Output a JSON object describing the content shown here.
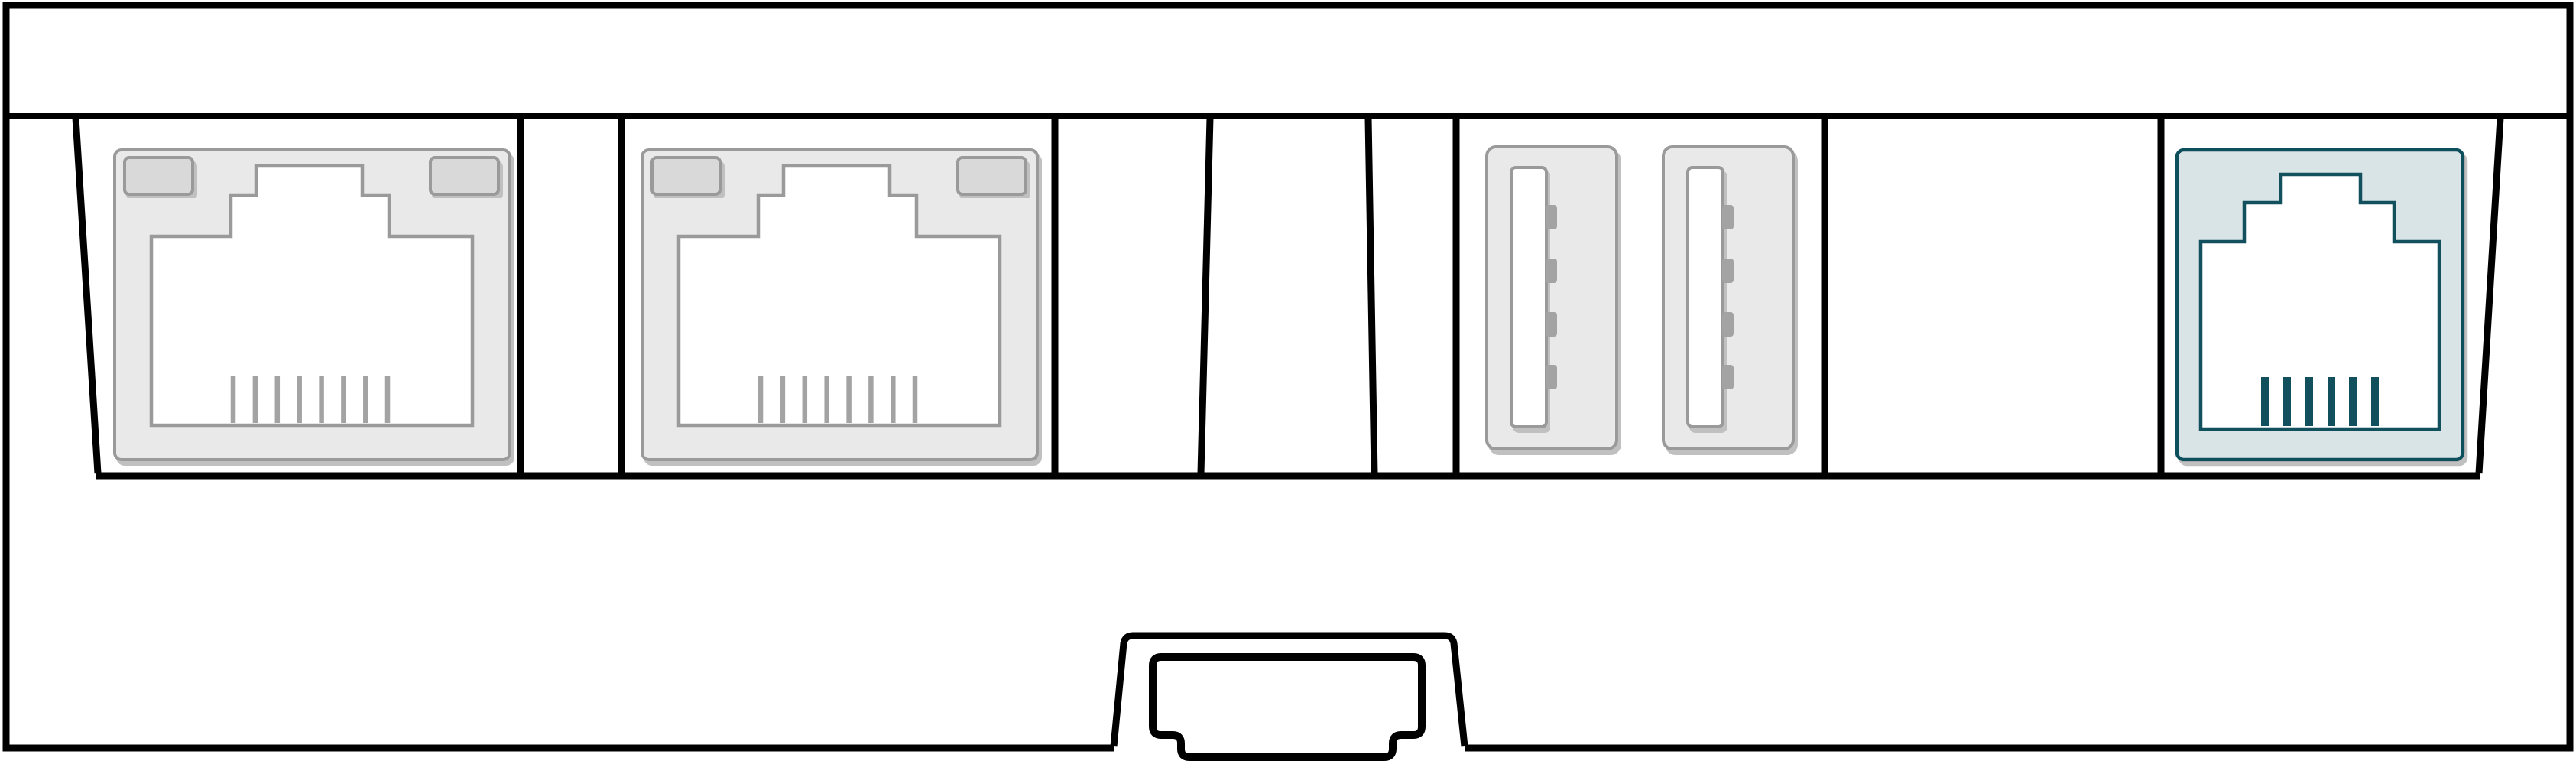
{
  "diagram": {
    "kind": "device-rear-panel-line-illustration",
    "ports": [
      {
        "id": "ethernet-port-1",
        "connector": "rj45",
        "pins": 8,
        "accent": false
      },
      {
        "id": "ethernet-port-2",
        "connector": "rj45",
        "pins": 8,
        "accent": false
      },
      {
        "id": "blank-slot",
        "connector": "empty-bay"
      },
      {
        "id": "usb-port-1",
        "connector": "usb-a",
        "contacts": 4
      },
      {
        "id": "usb-port-2",
        "connector": "usb-a",
        "contacts": 4
      },
      {
        "id": "console-port",
        "connector": "rj45",
        "pins": 6,
        "accent": true
      }
    ],
    "bottom_connector": {
      "id": "expansion-connector",
      "shape": "notched-socket-in-trapezoid-bump"
    }
  },
  "colors": {
    "background": "#ffffff",
    "line": "#000000",
    "port_stroke": "#9a9a9a",
    "port_fill": "#e9e9e9",
    "port_tab_fill": "#d9d9d9",
    "port_inner_fill": "#ffffff",
    "pin_gray": "#a3a3a3",
    "shadow": "#c0c0c0",
    "console_stroke": "#11505c",
    "console_fill": "#d9e4e6"
  }
}
